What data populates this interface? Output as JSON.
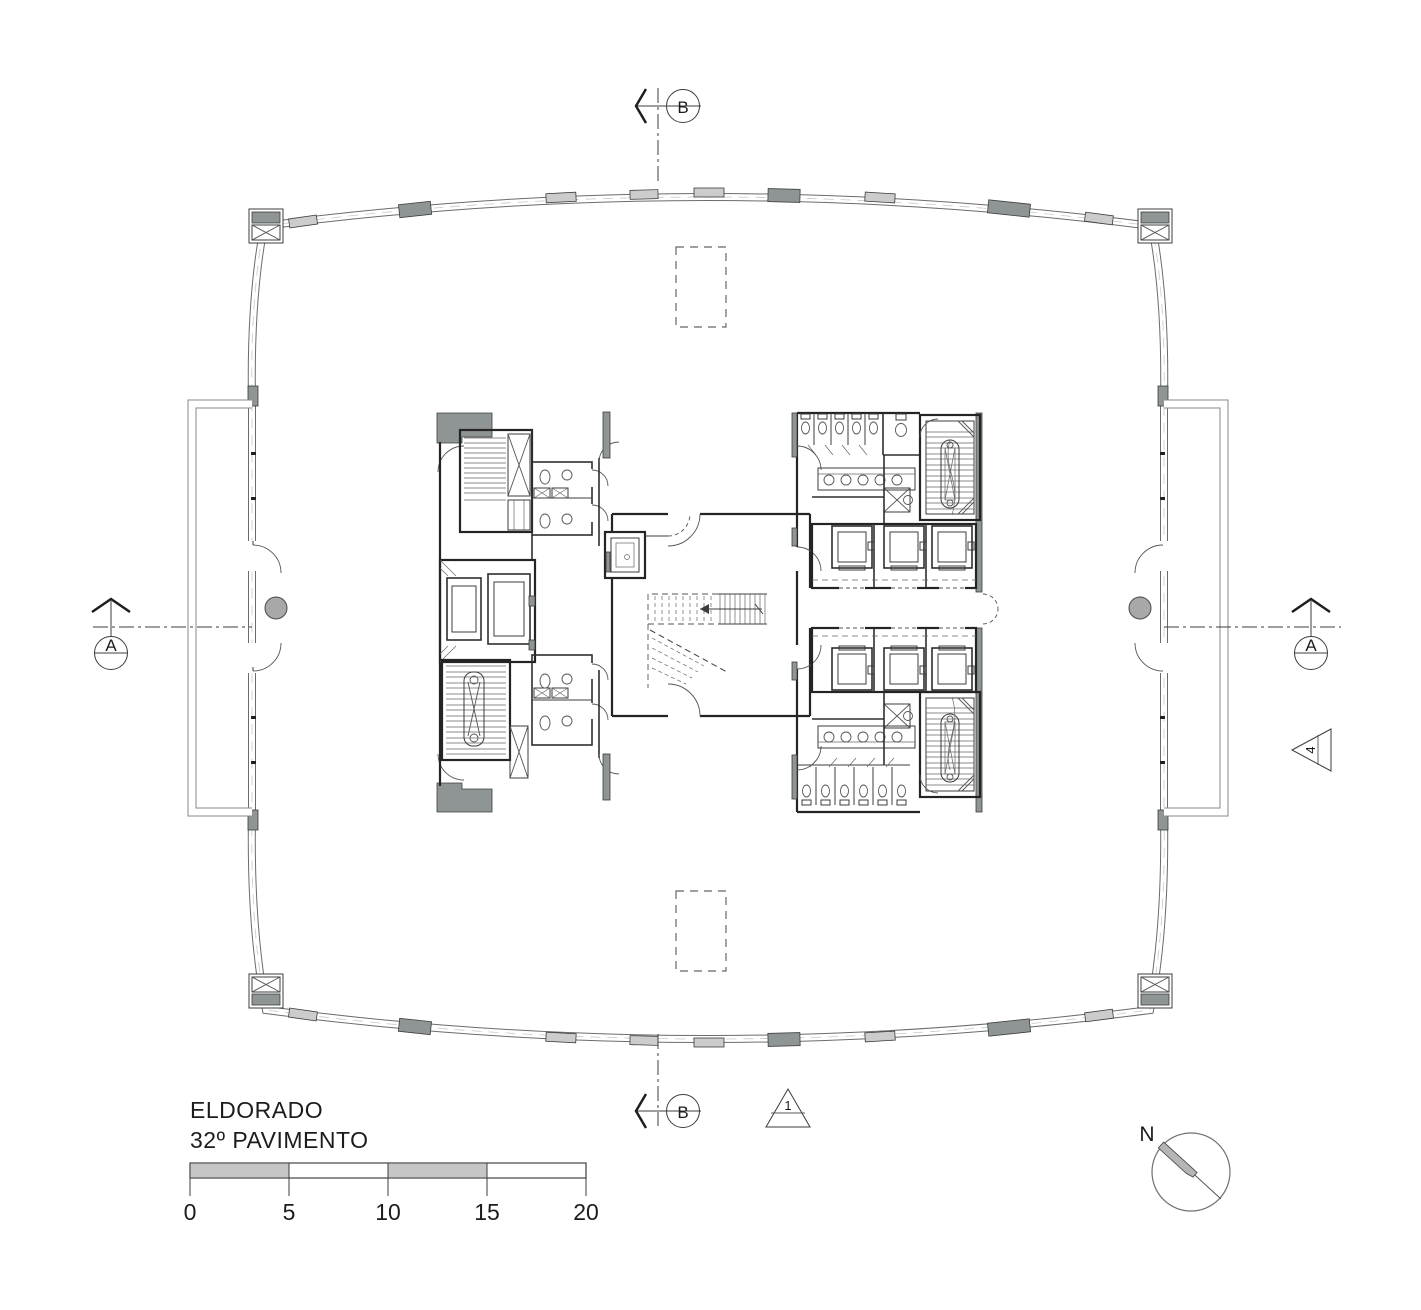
{
  "drawing": {
    "title_line1": "ELDORADO",
    "title_line2": "32º PAVIMENTO",
    "north_label": "N",
    "markers": {
      "section_b": "B",
      "section_a": "A",
      "detail_1": "1",
      "detail_4": "4"
    },
    "scale_labels": [
      "0",
      "5",
      "10",
      "15",
      "20"
    ],
    "colors": {
      "line": "#3c3c3c",
      "wall": "#242424",
      "panel_dark": "#8f9494",
      "panel_light": "#cccccc",
      "column_fill": "#a8a8a8",
      "scale_gray": "#c6c6c6",
      "background": "#ffffff"
    }
  }
}
